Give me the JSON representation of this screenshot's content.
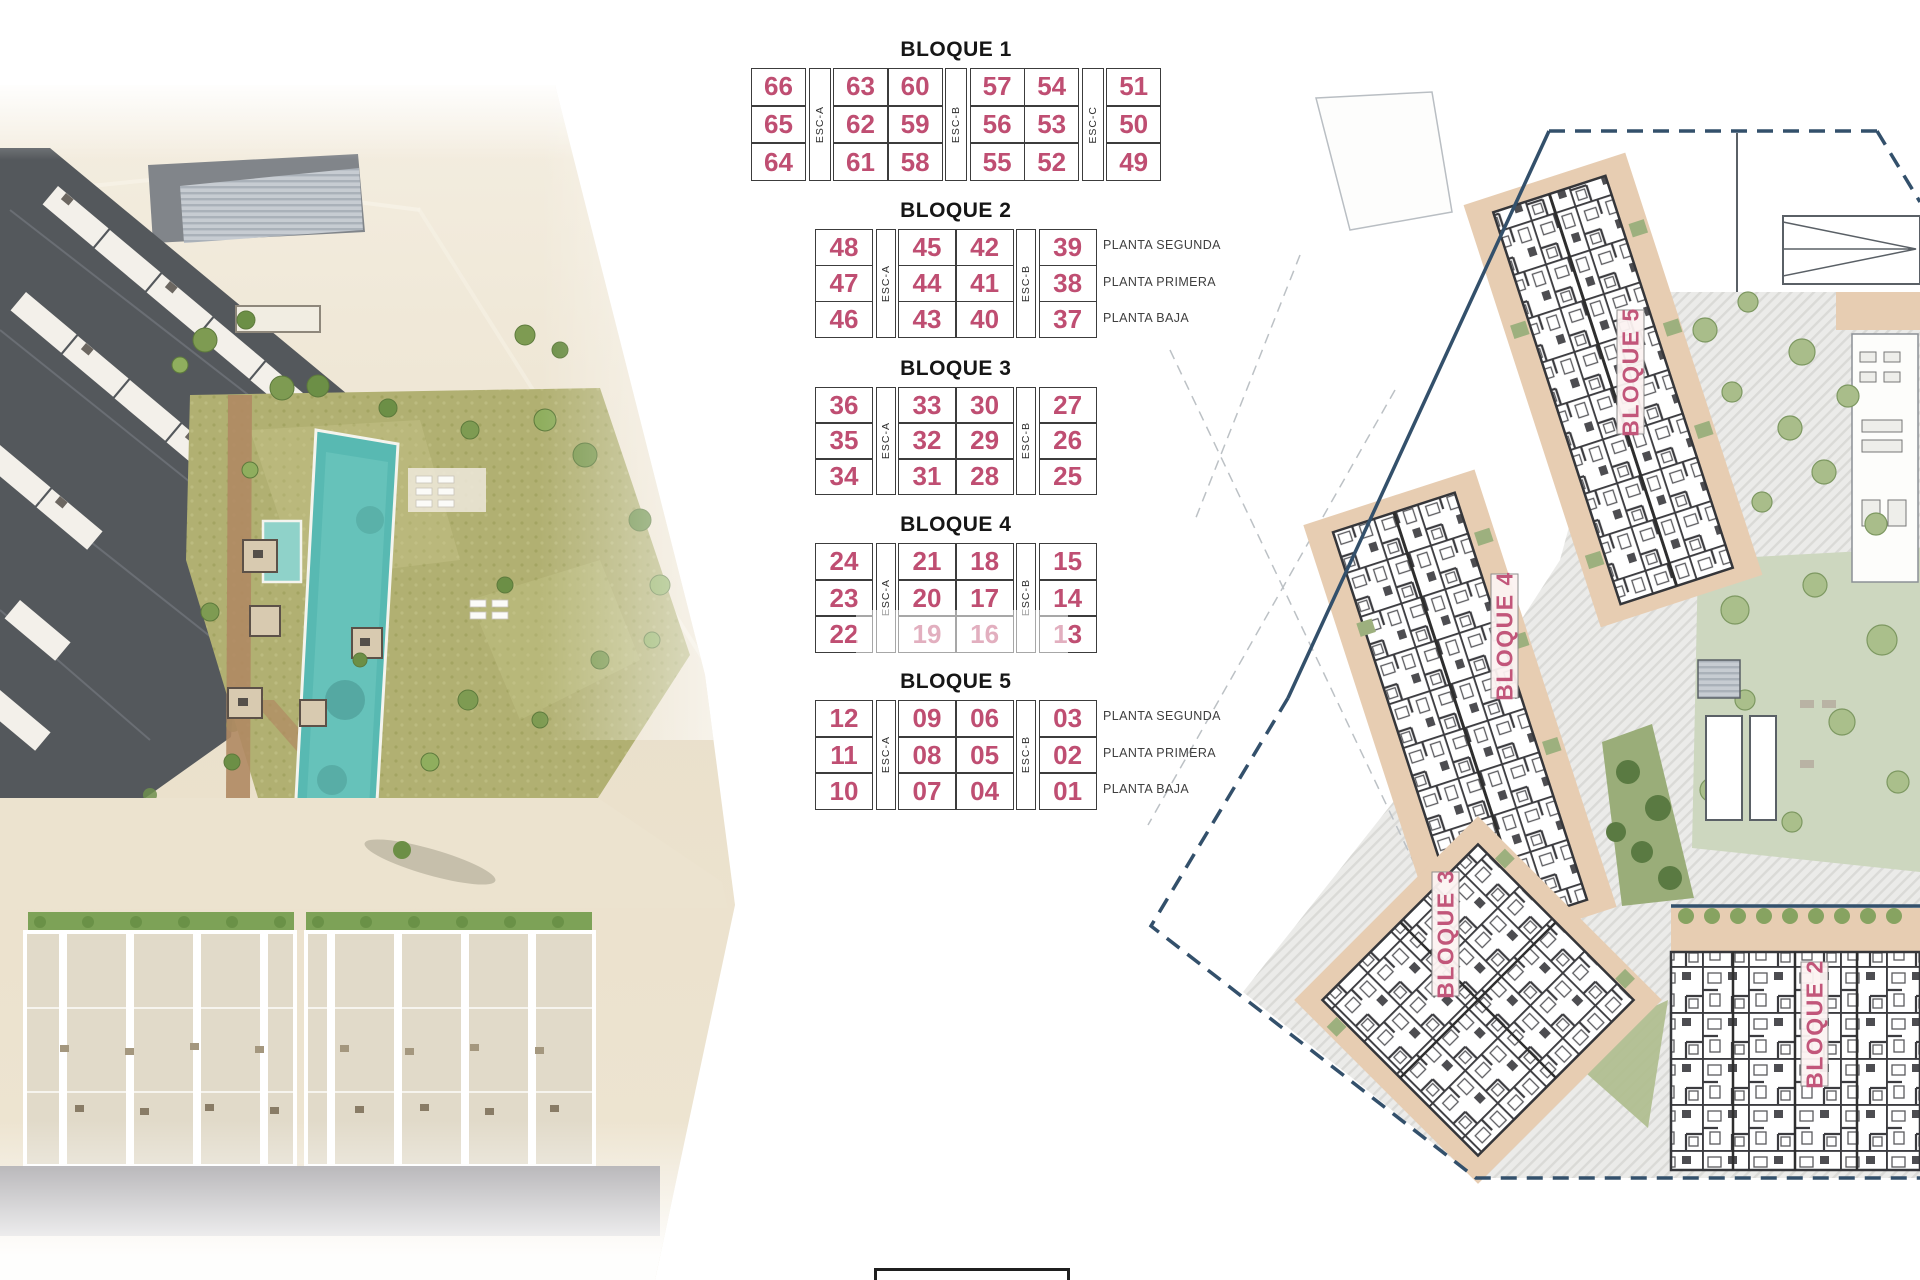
{
  "blocks": [
    {
      "title": "BLOQUE 1",
      "esc_labels": [
        "ESC-A",
        "ESC-B",
        "ESC-C"
      ],
      "rows": [
        [
          "66",
          "63",
          "60",
          "57",
          "54",
          "51"
        ],
        [
          "65",
          "62",
          "59",
          "56",
          "53",
          "50"
        ],
        [
          "64",
          "61",
          "58",
          "55",
          "52",
          "49"
        ]
      ],
      "planta_labels": []
    },
    {
      "title": "BLOQUE 2",
      "esc_labels": [
        "ESC-A",
        "ESC-B"
      ],
      "rows": [
        [
          "48",
          "45",
          "42",
          "39"
        ],
        [
          "47",
          "44",
          "41",
          "38"
        ],
        [
          "46",
          "43",
          "40",
          "37"
        ]
      ],
      "planta_labels": [
        "PLANTA SEGUNDA",
        "PLANTA PRIMERA",
        "PLANTA BAJA"
      ]
    },
    {
      "title": "BLOQUE 3",
      "esc_labels": [
        "ESC-A",
        "ESC-B"
      ],
      "rows": [
        [
          "36",
          "33",
          "30",
          "27"
        ],
        [
          "35",
          "32",
          "29",
          "26"
        ],
        [
          "34",
          "31",
          "28",
          "25"
        ]
      ],
      "planta_labels": []
    },
    {
      "title": "BLOQUE 4",
      "esc_labels": [
        "ESC-A",
        "ESC-B"
      ],
      "rows": [
        [
          "24",
          "21",
          "18",
          "15"
        ],
        [
          "23",
          "20",
          "17",
          "14"
        ],
        [
          "22",
          "19",
          "16",
          "13"
        ]
      ],
      "planta_labels": []
    },
    {
      "title": "BLOQUE 5",
      "esc_labels": [
        "ESC-A",
        "ESC-B"
      ],
      "rows": [
        [
          "12",
          "09",
          "06",
          "03"
        ],
        [
          "11",
          "08",
          "05",
          "02"
        ],
        [
          "10",
          "07",
          "04",
          "01"
        ]
      ],
      "planta_labels": [
        "PLANTA SEGUNDA",
        "PLANTA PRIMERA",
        "PLANTA BAJA"
      ]
    }
  ],
  "site_plan": {
    "block_labels": [
      "BLOQUE 5",
      "BLOQUE 4",
      "BLOQUE 3",
      "BLOQUE 2"
    ]
  },
  "colors": {
    "unit_number": "#bf4e72",
    "plan_label": "#c2567a",
    "boundary": "#33506b",
    "table_border": "#3c3c3c",
    "planta_text": "#3f3f3f",
    "pool": "#58b9b2",
    "lawn": "#b1b072",
    "terrace_tan": "#e7cdb2"
  }
}
